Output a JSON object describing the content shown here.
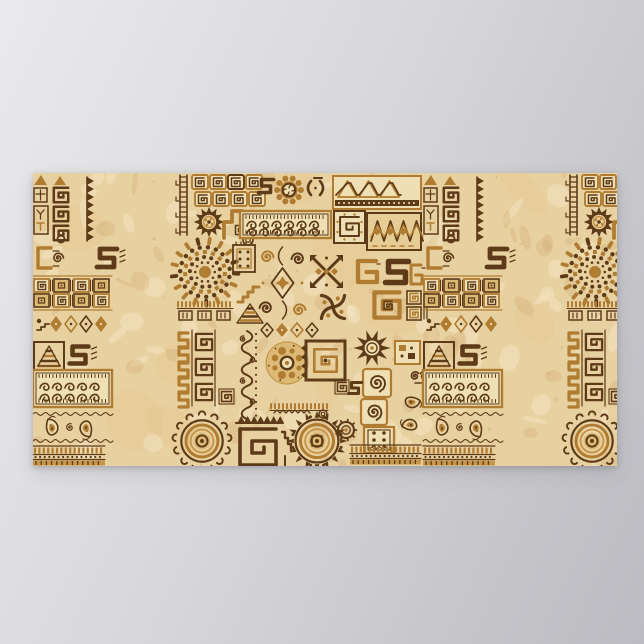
{
  "meta": {
    "description": "Horizontal poster print of an African ethnic handmade ornament pattern: rows of tribal motifs (suns, spirals, Greek-key meanders, triangles, paisleys, gears, zigzag bands) in dark brown and caramel on a mottled beige parchment background, shown against a plain gray backdrop."
  },
  "scene": {
    "background": {
      "top": "#eae9eb",
      "mid": "#d8d7da",
      "bottom": "#bbbbc1"
    },
    "poster": {
      "x": 33,
      "y": 173,
      "width": 584,
      "height": 293,
      "tile_width": 390,
      "palette": {
        "parchment": "#e8d1a0",
        "light": "#f3e6c3",
        "shade": "#d9b981",
        "shade2": "#cfa868",
        "dark": "#5d3b18",
        "dark2": "#744e20",
        "caramel": "#b07c31",
        "caramel2": "#c6974b",
        "tan": "#dcba76",
        "cream": "#eedfb4"
      },
      "motifs": [
        {
          "type": "glyph-block",
          "x": 0,
          "y": 2,
          "w": 16,
          "h": 28
        },
        {
          "type": "sawtooth-strip",
          "x": 18,
          "y": 2,
          "w": 44,
          "h": 68
        },
        {
          "type": "yt-block",
          "x": 0,
          "y": 33,
          "w": 17,
          "h": 30
        },
        {
          "type": "curl-glyph",
          "x": 0,
          "y": 73,
          "w": 32,
          "h": 24
        },
        {
          "type": "s-glyph",
          "cx": 74,
          "cy": 85,
          "s": 20,
          "color": "dark",
          "marks": true
        },
        {
          "type": "kilim-band",
          "x": 0,
          "y": 103,
          "w": 79,
          "h": 34
        },
        {
          "type": "diamond-row",
          "x": 0,
          "y": 141,
          "w": 84,
          "h": 20,
          "bird": true
        },
        {
          "type": "step-triangle",
          "x": 1,
          "y": 169,
          "w": 30,
          "h": 28
        },
        {
          "type": "s-glyph",
          "cx": 46,
          "cy": 182,
          "s": 19,
          "color": "dark",
          "marks": true
        },
        {
          "type": "wave-band",
          "x": 0,
          "y": 197,
          "w": 79,
          "h": 37
        },
        {
          "type": "paisley-band",
          "x": 0,
          "y": 238,
          "w": 77,
          "h": 33
        },
        {
          "type": "tick-band",
          "x": 0,
          "y": 273,
          "w": 72,
          "h": 20
        },
        {
          "type": "ladder-strip",
          "x": 142,
          "y": 2,
          "w": 15,
          "h": 60
        },
        {
          "type": "key-blocks",
          "x": 159,
          "y": 2,
          "cols": 4,
          "rows": 2,
          "cw": 16,
          "ch": 14,
          "gap": 2
        },
        {
          "type": "dark-sun",
          "cx": 176,
          "cy": 49,
          "r": 15
        },
        {
          "type": "llama",
          "x": 189,
          "y": 35,
          "w": 33,
          "h": 31
        },
        {
          "type": "circle-glyph",
          "cx": 215,
          "cy": 67,
          "r": 5
        },
        {
          "type": "dotted-circle",
          "cx": 172,
          "cy": 99,
          "r": 35
        },
        {
          "type": "meander-row",
          "x": 144,
          "y": 128,
          "w": 56,
          "h": 20
        },
        {
          "type": "greek-key-strip",
          "x": 142,
          "y": 157,
          "w": 41,
          "h": 76
        },
        {
          "type": "small-key",
          "x": 187,
          "y": 217,
          "s": 13
        },
        {
          "type": "big-sun",
          "cx": 169,
          "cy": 268,
          "r": 28,
          "variant": "u"
        },
        {
          "type": "s-glyph",
          "cx": 233,
          "cy": 13,
          "s": 15,
          "color": "dark"
        },
        {
          "type": "gear-flower",
          "cx": 256,
          "cy": 17,
          "r": 14
        },
        {
          "type": "bracket-glyph",
          "x": 272,
          "y": 5,
          "w": 22,
          "h": 20
        },
        {
          "type": "triangle-band",
          "x": 300,
          "y": 3,
          "w": 88,
          "h": 33
        },
        {
          "type": "wave-band",
          "x": 207,
          "y": 38,
          "w": 91,
          "h": 27
        },
        {
          "type": "labyrinth-square",
          "x": 301,
          "y": 38,
          "w": 31,
          "h": 32,
          "style": "dots"
        },
        {
          "type": "kilim-panel",
          "x": 334,
          "y": 40,
          "w": 54,
          "h": 37
        },
        {
          "type": "dot-square",
          "x": 200,
          "y": 72,
          "w": 22,
          "h": 27,
          "style": "dark"
        },
        {
          "type": "vine-panel",
          "x": 224,
          "y": 72,
          "w": 51,
          "h": 76
        },
        {
          "type": "x-square",
          "x": 277,
          "y": 82,
          "s": 33
        },
        {
          "type": "hook-glyph",
          "x": 320,
          "y": 86,
          "w": 27,
          "h": 26
        },
        {
          "type": "s-glyph",
          "cx": 364,
          "cy": 99,
          "s": 23,
          "color": "dark"
        },
        {
          "type": "hook-glyph",
          "x": 373,
          "y": 90,
          "w": 19,
          "h": 24
        },
        {
          "type": "steps-glyph",
          "x": 205,
          "y": 112,
          "w": 21,
          "h": 17
        },
        {
          "type": "striped-triangle",
          "x": 204,
          "y": 131,
          "w": 26,
          "h": 19
        },
        {
          "type": "pinwheel",
          "cx": 300,
          "cy": 134,
          "r": 17
        },
        {
          "type": "hook-square",
          "x": 337,
          "y": 115,
          "s": 34
        },
        {
          "type": "framed-keys",
          "x": 374,
          "y": 118,
          "w": 22,
          "h": 30
        },
        {
          "type": "diamond-row",
          "x": 226,
          "y": 150,
          "w": 74,
          "h": 14
        },
        {
          "type": "curl-strip",
          "x": 206,
          "y": 158,
          "w": 20,
          "h": 86
        },
        {
          "type": "tan-gear",
          "cx": 254,
          "cy": 190,
          "r": 21
        },
        {
          "type": "labyrinth-square",
          "x": 273,
          "y": 168,
          "w": 39,
          "h": 39,
          "style": "thick"
        },
        {
          "type": "spiky-sun",
          "cx": 339,
          "cy": 175,
          "r": 18
        },
        {
          "type": "dot-square",
          "x": 362,
          "y": 168,
          "w": 25,
          "h": 23,
          "style": "caramel"
        },
        {
          "type": "vine-glyph",
          "x": 377,
          "y": 194,
          "w": 18,
          "h": 18
        },
        {
          "type": "spiral-square",
          "x": 330,
          "y": 196,
          "s": 28
        },
        {
          "type": "spiral-square",
          "x": 328,
          "y": 226,
          "s": 26
        },
        {
          "type": "kilim-dot-square",
          "x": 331,
          "y": 254,
          "w": 30,
          "h": 26
        },
        {
          "type": "paisley-pair",
          "x": 365,
          "y": 218,
          "w": 26,
          "h": 46
        },
        {
          "type": "small-key",
          "x": 303,
          "y": 208,
          "s": 12
        },
        {
          "type": "s-glyph",
          "cx": 322,
          "cy": 215,
          "s": 13,
          "color": "dark"
        },
        {
          "type": "meander-row",
          "x": 237,
          "y": 230,
          "w": 58,
          "h": 11,
          "thin": true
        },
        {
          "type": "big-step-spiral",
          "x": 203,
          "y": 243,
          "w": 52,
          "h": 50
        },
        {
          "type": "circle-glyph",
          "cx": 290,
          "cy": 241,
          "r": 4
        },
        {
          "type": "big-sun",
          "cx": 284,
          "cy": 268,
          "r": 29,
          "variant": "tri"
        },
        {
          "type": "gear-small",
          "cx": 313,
          "cy": 257,
          "r": 10
        },
        {
          "type": "tick-band",
          "x": 317,
          "y": 272,
          "w": 71,
          "h": 20
        }
      ]
    }
  }
}
